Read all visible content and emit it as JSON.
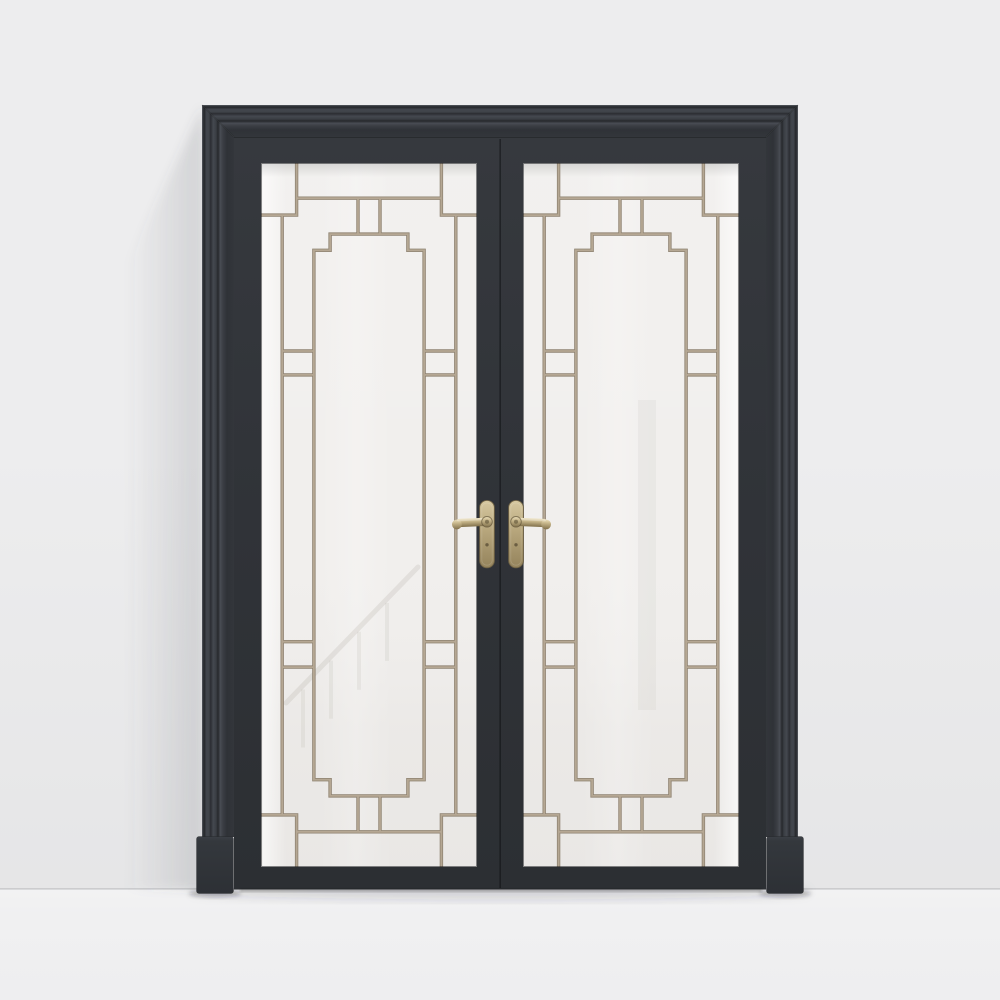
{
  "meta": {
    "type": "3d-product-render",
    "subject": "black double interior door with frosted glass, art-deco tan muntin grilles and brass lever handles, front view on light gray wall and floor"
  },
  "colors": {
    "wall": "#ededee",
    "floor": "#f0f0f1",
    "floor_line": "rgba(138,141,146,0.40)",
    "casing_face": "#33363b",
    "leaf": "#303338",
    "glass": "#f1efed",
    "muntin": "#b5a793",
    "muntin_edge": "#8f8372",
    "seam": "rgba(12,13,15,0.50)",
    "brass_light": "#ecdfba",
    "brass_mid": "#bcab81",
    "brass_dark": "#7c6c49",
    "plate_stroke": "#6d6044",
    "keyhole": "#6b5e42",
    "mitre": "rgba(10,11,12,0.35)",
    "under_door_shadow": "rgba(30,32,36,0.30)",
    "floor_soft_shadow": "rgba(44,47,53,0.16)"
  },
  "gradients": {
    "moldTop": {
      "dir": [
        0,
        0,
        0,
        1
      ],
      "stops": [
        [
          0,
          "#60646b"
        ],
        [
          0.03,
          "#34373c"
        ],
        [
          0.07,
          "#26282c"
        ],
        [
          0.14,
          "#42464d"
        ],
        [
          0.22,
          "#3f4349"
        ],
        [
          0.27,
          "#2b2d32"
        ],
        [
          0.35,
          "#44484f"
        ],
        [
          0.44,
          "#3a3e44"
        ],
        [
          0.5,
          "#26282c"
        ],
        [
          0.57,
          "#484c53"
        ],
        [
          0.66,
          "#3a3d43"
        ],
        [
          0.78,
          "#2f3237"
        ],
        [
          1,
          "#33363b"
        ]
      ]
    },
    "moldLeft": {
      "dir": [
        0,
        0,
        1,
        0
      ],
      "stops": [
        [
          0,
          "#60646b"
        ],
        [
          0.03,
          "#34373c"
        ],
        [
          0.07,
          "#26282c"
        ],
        [
          0.14,
          "#42464d"
        ],
        [
          0.22,
          "#3f4349"
        ],
        [
          0.27,
          "#2b2d32"
        ],
        [
          0.35,
          "#44484f"
        ],
        [
          0.44,
          "#3a3e44"
        ],
        [
          0.5,
          "#26282c"
        ],
        [
          0.57,
          "#484c53"
        ],
        [
          0.66,
          "#3a3d43"
        ],
        [
          0.78,
          "#2f3237"
        ],
        [
          1,
          "#33363b"
        ]
      ]
    },
    "moldRight": {
      "dir": [
        1,
        0,
        0,
        0
      ],
      "stops": [
        [
          0,
          "#60646b"
        ],
        [
          0.03,
          "#34373c"
        ],
        [
          0.07,
          "#26282c"
        ],
        [
          0.14,
          "#42464d"
        ],
        [
          0.22,
          "#3f4349"
        ],
        [
          0.27,
          "#2b2d32"
        ],
        [
          0.35,
          "#44484f"
        ],
        [
          0.44,
          "#3a3e44"
        ],
        [
          0.5,
          "#26282c"
        ],
        [
          0.57,
          "#484c53"
        ],
        [
          0.66,
          "#3a3d43"
        ],
        [
          0.78,
          "#2f3237"
        ],
        [
          1,
          "#33363b"
        ]
      ]
    },
    "leafGrad": {
      "dir": [
        0,
        0,
        0,
        1
      ],
      "stops": [
        [
          0,
          "#36393e"
        ],
        [
          0.5,
          "#303338"
        ],
        [
          1,
          "#2c2f33"
        ]
      ]
    },
    "plinthGrad": {
      "dir": [
        0,
        0,
        0,
        1
      ],
      "stops": [
        [
          0,
          "#3c4046"
        ],
        [
          0.08,
          "#34383d"
        ],
        [
          1,
          "#2d3035"
        ]
      ]
    },
    "plateGrad": {
      "dir": [
        0,
        0,
        0,
        1
      ],
      "stops": [
        [
          0,
          "#d6c8a0"
        ],
        [
          0.45,
          "#b7a67c"
        ],
        [
          1,
          "#94835c"
        ]
      ]
    },
    "leverGrad": {
      "dir": [
        0,
        0,
        0,
        1
      ],
      "stops": [
        [
          0,
          "#ecdfba"
        ],
        [
          0.4,
          "#c3b287"
        ],
        [
          1,
          "#82714c"
        ]
      ]
    },
    "glassEdgeL": {
      "dir": [
        0,
        0,
        1,
        0
      ],
      "stops": [
        [
          0,
          "rgba(255,255,255,0.65)"
        ],
        [
          1,
          "rgba(255,255,255,0)"
        ]
      ]
    },
    "glassEdgeR": {
      "dir": [
        1,
        0,
        0,
        0
      ],
      "stops": [
        [
          0,
          "rgba(255,255,255,0.65)"
        ],
        [
          1,
          "rgba(255,255,255,0)"
        ]
      ]
    },
    "glassBand": {
      "dir": [
        0,
        0,
        1,
        0
      ],
      "stops": [
        [
          0,
          "rgba(255,255,255,0)"
        ],
        [
          0.5,
          "rgba(255,255,255,0.20)"
        ],
        [
          1,
          "rgba(255,255,255,0)"
        ]
      ]
    },
    "glassVert": {
      "dir": [
        0,
        0,
        0,
        1
      ],
      "stops": [
        [
          0,
          "rgba(255,255,255,0.10)"
        ],
        [
          0.5,
          "rgba(255,255,255,0)"
        ],
        [
          0.8,
          "rgba(186,183,178,0.10)"
        ],
        [
          1,
          "rgba(186,183,178,0.14)"
        ]
      ]
    },
    "glassTopShade": {
      "dir": [
        0,
        0,
        0,
        1
      ],
      "stops": [
        [
          0,
          "rgba(100,102,105,0.20)"
        ],
        [
          1,
          "rgba(100,102,105,0)"
        ]
      ]
    },
    "wallShadowGrad": {
      "dir": [
        1,
        0,
        0,
        0
      ],
      "stops": [
        [
          0,
          "rgba(86,90,98,0.18)"
        ],
        [
          0.6,
          "rgba(86,90,98,0.07)"
        ],
        [
          1,
          "rgba(86,90,98,0)"
        ]
      ]
    },
    "wallBottom": {
      "dir": [
        0,
        0,
        0,
        1
      ],
      "stops": [
        [
          0,
          "rgba(90,93,99,0)"
        ],
        [
          1,
          "rgba(90,93,99,0.05)"
        ]
      ]
    },
    "floorGrad": {
      "dir": [
        0,
        0,
        0,
        1
      ],
      "stops": [
        [
          0,
          "#f2f2f3"
        ],
        [
          0.25,
          "#f0f0f1"
        ],
        [
          1,
          "#eeeef0"
        ]
      ]
    }
  },
  "panels": [
    {
      "name": "left",
      "rect": [
        261,
        163,
        216,
        704
      ],
      "glow": "left"
    },
    {
      "name": "right",
      "rect": [
        523,
        163,
        216,
        704
      ],
      "glow": "right"
    }
  ],
  "muntin_segments": [
    [
      0.165,
      0,
      0.165,
      0.074
    ],
    [
      0,
      0.074,
      0.165,
      0.074
    ],
    [
      0.835,
      0,
      0.835,
      0.074
    ],
    [
      0.835,
      0.074,
      1,
      0.074
    ],
    [
      0.165,
      0.926,
      0.165,
      1
    ],
    [
      0,
      0.926,
      0.165,
      0.926
    ],
    [
      0.835,
      0.926,
      0.835,
      1
    ],
    [
      0.835,
      0.926,
      1,
      0.926
    ],
    [
      0.165,
      0.05,
      0.835,
      0.05
    ],
    [
      0.449,
      0.05,
      0.449,
      0.101
    ],
    [
      0.551,
      0.05,
      0.551,
      0.101
    ],
    [
      0.32,
      0.101,
      0.68,
      0.101
    ],
    [
      0.32,
      0.101,
      0.32,
      0.124
    ],
    [
      0.68,
      0.101,
      0.68,
      0.124
    ],
    [
      0.245,
      0.124,
      0.32,
      0.124
    ],
    [
      0.68,
      0.124,
      0.755,
      0.124
    ],
    [
      0.165,
      0.95,
      0.835,
      0.95
    ],
    [
      0.449,
      0.899,
      0.449,
      0.95
    ],
    [
      0.551,
      0.899,
      0.551,
      0.95
    ],
    [
      0.32,
      0.899,
      0.68,
      0.899
    ],
    [
      0.32,
      0.876,
      0.32,
      0.899
    ],
    [
      0.68,
      0.876,
      0.68,
      0.899
    ],
    [
      0.245,
      0.876,
      0.32,
      0.876
    ],
    [
      0.68,
      0.876,
      0.755,
      0.876
    ],
    [
      0.098,
      0.074,
      0.098,
      0.926
    ],
    [
      0.902,
      0.074,
      0.902,
      0.926
    ],
    [
      0.245,
      0.124,
      0.245,
      0.876
    ],
    [
      0.755,
      0.124,
      0.755,
      0.876
    ],
    [
      0.098,
      0.267,
      0.245,
      0.267
    ],
    [
      0.098,
      0.301,
      0.245,
      0.301
    ],
    [
      0.098,
      0.68,
      0.245,
      0.68
    ],
    [
      0.098,
      0.716,
      0.245,
      0.716
    ],
    [
      0.755,
      0.267,
      0.902,
      0.267
    ],
    [
      0.755,
      0.301,
      0.902,
      0.301
    ],
    [
      0.755,
      0.68,
      0.902,
      0.68
    ],
    [
      0.755,
      0.716,
      0.902,
      0.716
    ]
  ],
  "reflections": {
    "left": {
      "rail": [
        [
          418,
          567
        ],
        [
          286,
          703
        ]
      ],
      "balusters_x": [
        303,
        331,
        359,
        387
      ],
      "baluster_len": 58
    },
    "right": {
      "band_x": 638,
      "band_y": 400,
      "band_w": 18,
      "band_h": 310
    }
  },
  "handles": {
    "count": 2,
    "finish": "brass",
    "type": "lever-on-long-plate",
    "keyhole": true
  }
}
